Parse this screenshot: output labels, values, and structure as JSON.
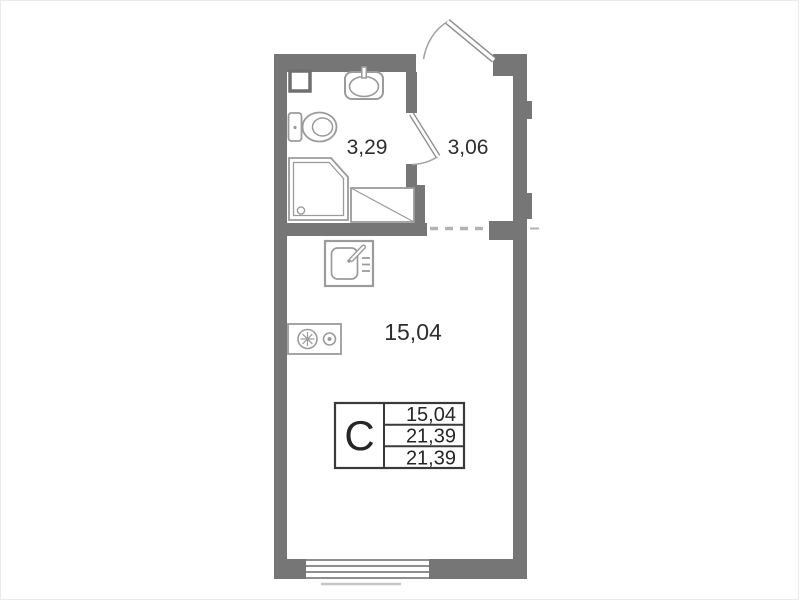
{
  "page": {
    "title": "Studio apartment floor plan"
  },
  "colors": {
    "wall": "#767676",
    "fixture_line": "#9b9b9b",
    "door_line": "#8f8f8f",
    "arc_line": "#a3a3a3",
    "dash_line": "#b3b3b3",
    "window_line": "#8f8f8f",
    "sill_line": "#c6c6c6",
    "label_text": "#2e2e2e",
    "table_border": "#3a3a3a"
  },
  "rooms": {
    "bathroom": {
      "area": "3,29"
    },
    "hallway": {
      "area": "3,06"
    },
    "living": {
      "area": "15,04"
    }
  },
  "legend": {
    "type_letter": "С",
    "rows": [
      "15,04",
      "21,39",
      "21,39"
    ]
  },
  "fixtures": [
    "vent-shaft",
    "washbasin",
    "toilet",
    "shower-cabin",
    "washing-machine-place",
    "kitchen-sink",
    "stove",
    "entrance-door",
    "bathroom-door",
    "window",
    "opening-dashed"
  ]
}
